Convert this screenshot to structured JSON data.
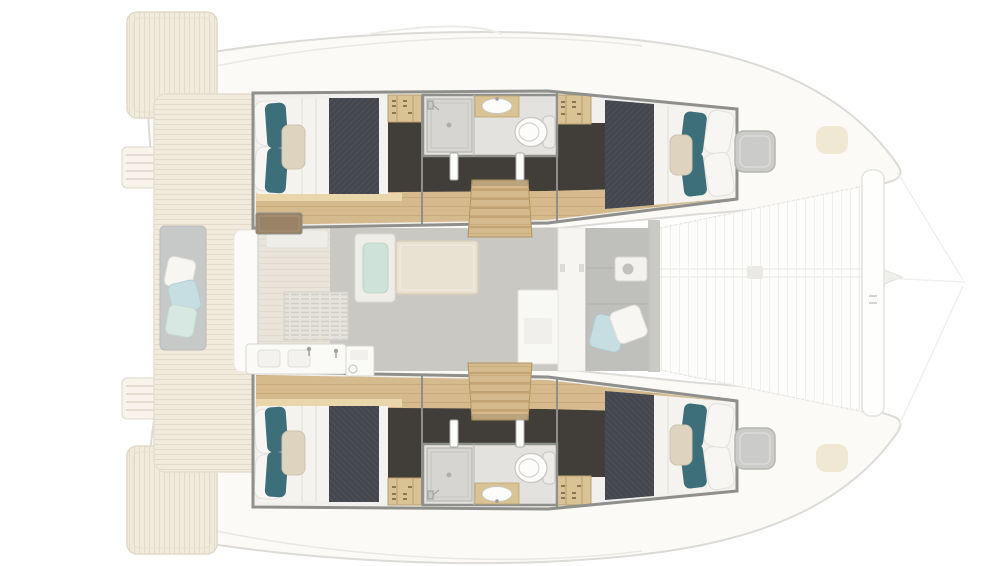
{
  "scene": {
    "type": "floor-plan",
    "subject": "catamaran interior layout, top-down view, bow to the right",
    "view": "top-down",
    "bow_direction": "right"
  },
  "features": {
    "cabins": 4,
    "bathrooms": 2,
    "double_beds": 4,
    "berths": [
      "port aft double",
      "port forward double",
      "starboard aft double",
      "starboard forward double"
    ],
    "bathroom_fixtures": [
      "shower",
      "sink",
      "toilet"
    ],
    "salon": [
      "galley vent",
      "galley sink",
      "appliance",
      "dining table",
      "bench seat",
      "nav cabinet"
    ],
    "exterior": [
      "aft cockpit bench with cushions",
      "teak cockpit floor",
      "swim platforms",
      "transom ladders",
      "forward lounge with pillows",
      "trampoline",
      "forward crossbeam",
      "bowsprit",
      "deck hatches"
    ]
  },
  "colors": {
    "bg": "#ffffff",
    "hull_ghost_fill": "#fbfaf7",
    "ghost_line": "#dcdbd7",
    "sheer_line": "#e9e8e4",
    "teak": "#f1ebdd",
    "teak_line": "#e0d7c2",
    "frame": "#8f8f8b",
    "cabin_white": "#f1f0ec",
    "wood": "#d5ba8e",
    "wood_light": "#ecd9ae",
    "wood_line": "#bb9d6c",
    "dark_floor": "#413d39",
    "bed_white": "#f4f3ef",
    "bed_fold": "#e0dfda",
    "duvet": "#44474e",
    "duvet_line": "#51545b",
    "teal_pillow": "#3d6f7b",
    "white_pillow": "#f7f6f2",
    "knit_pillow": "#ded3bf",
    "bath_floor": "#e3e2df",
    "shower_tray": "#d6d5d1",
    "porcelain": "#fcfcfa",
    "wardrobe": "#d9c294",
    "wardrobe_line": "#b79f70",
    "door_white": "#fdfdfb",
    "salon_floor": "#cac8c3",
    "galley_floor": "#e9e4da",
    "grill_bg": "#e6e3dc",
    "grill_line": "#d2cfc7",
    "walnut": "#9a8266",
    "unit_white": "#fafaf7",
    "unit_line": "#d8d6d0",
    "table": "#e9e1d1",
    "table_edge": "#d9cfba",
    "bench": "#efede7",
    "bench_cushion": "#cfe2da",
    "nav_white": "#f8f8f5",
    "bulkhead": "#f6f5f1",
    "lounge": "#bfbfbb",
    "lounge_line": "#b0b0ac",
    "pillow_blue": "#c6dde1",
    "pillow_aqua": "#d7e7e1",
    "hatch_fill": "#cbcbc9",
    "hatch_line": "#b6b6b3",
    "beam": "#c3c3c0",
    "tramp": "#fdfdfc",
    "tramp_line": "#efeeec",
    "crossbeam": "#fefefd",
    "crossbeam_line": "#e3e2de",
    "pod": "#e8d8b7",
    "cockpit_bench": "#c7c9c8",
    "steps_edge": "#b1945f"
  }
}
